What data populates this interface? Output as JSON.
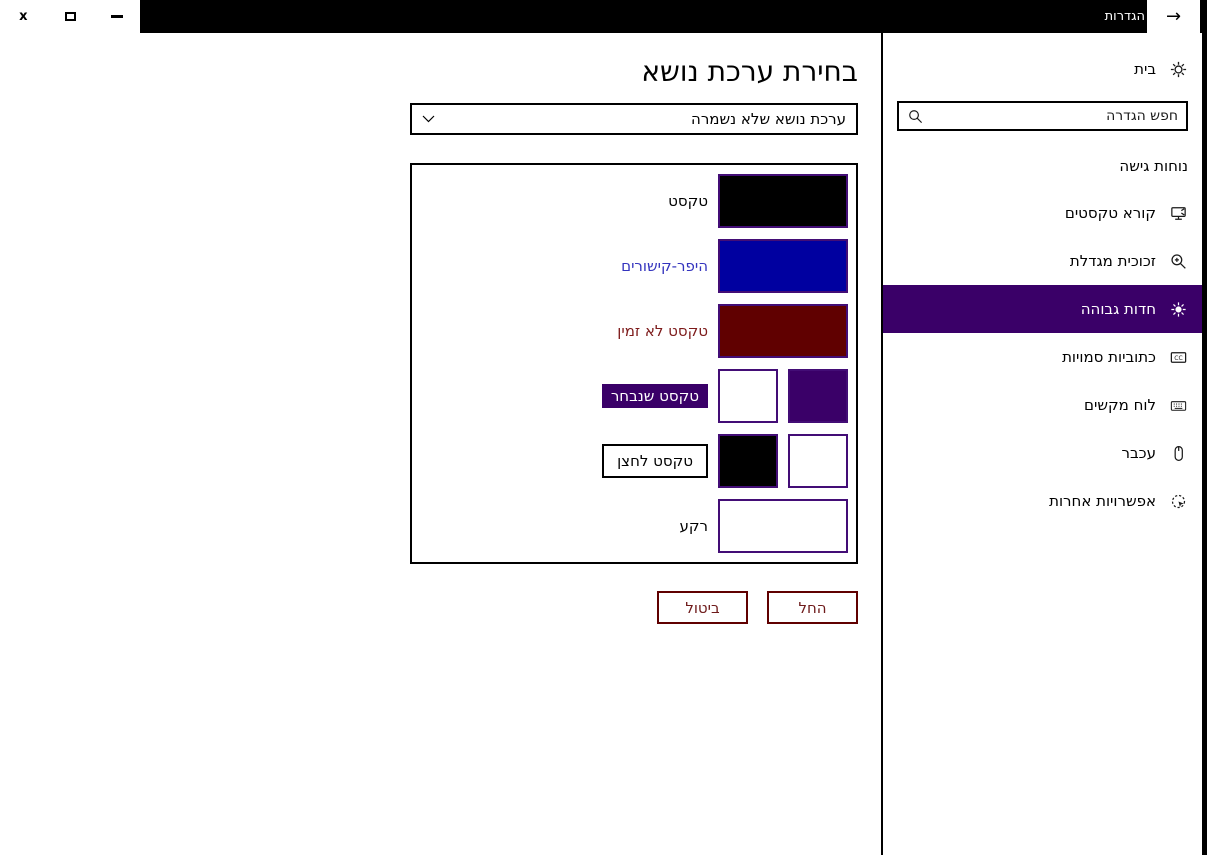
{
  "window": {
    "title": "הגדרות",
    "back_icon": "→",
    "controls": [
      {
        "icon": "close-icon",
        "glyph": "x"
      },
      {
        "icon": "maximize-icon"
      },
      {
        "icon": "minimize-icon"
      }
    ]
  },
  "sidebar": {
    "home_label": "בית",
    "home_icon": "gear-icon",
    "search_placeholder": "חפש הגדרה",
    "search_icon": "search-icon",
    "section_label": "נוחות גישה",
    "items": [
      {
        "label": "קורא טקסטים",
        "icon": "narrator-icon",
        "selected": false
      },
      {
        "label": "זכוכית מגדלת",
        "icon": "magnifier-icon",
        "selected": false
      },
      {
        "label": "חדות גבוהה",
        "icon": "high-contrast-sun-icon",
        "selected": true
      },
      {
        "label": "כתוביות סמויות",
        "icon": "closed-captions-icon",
        "selected": false
      },
      {
        "label": "לוח מקשים",
        "icon": "keyboard-icon",
        "selected": false
      },
      {
        "label": "עכבר",
        "icon": "mouse-icon",
        "selected": false
      },
      {
        "label": "אפשרויות אחרות",
        "icon": "other-options-icon",
        "selected": false
      }
    ]
  },
  "main": {
    "title": "בחירת ערכת נושא",
    "theme_dropdown": {
      "value": "ערכת נושא שלא נשמרה",
      "icon": "chevron-down-icon"
    },
    "rows": [
      {
        "label": "טקסט",
        "colors": [
          "#000000"
        ]
      },
      {
        "label": "היפר-קישורים",
        "colors": [
          "#0000A0"
        ]
      },
      {
        "label": "טקסט לא זמין",
        "colors": [
          "#600000"
        ]
      },
      {
        "label": "טקסט שנבחר",
        "colors": [
          "#3A0068",
          "#FFFFFF"
        ]
      },
      {
        "label": "טקסט לחצן",
        "colors": [
          "#FFFFFF",
          "#000000"
        ]
      },
      {
        "label": "רקע",
        "colors": [
          "#FFFFFF"
        ]
      }
    ],
    "buttons": {
      "apply": "החל",
      "cancel": "ביטול"
    }
  },
  "colors": {
    "accent": "#3A0068",
    "swatch-border": "#430D76",
    "link-text": "#3434BE",
    "disabled-text": "#7D1A1A",
    "btn-border": "#600000",
    "btn-text": "#6E1A1A"
  }
}
